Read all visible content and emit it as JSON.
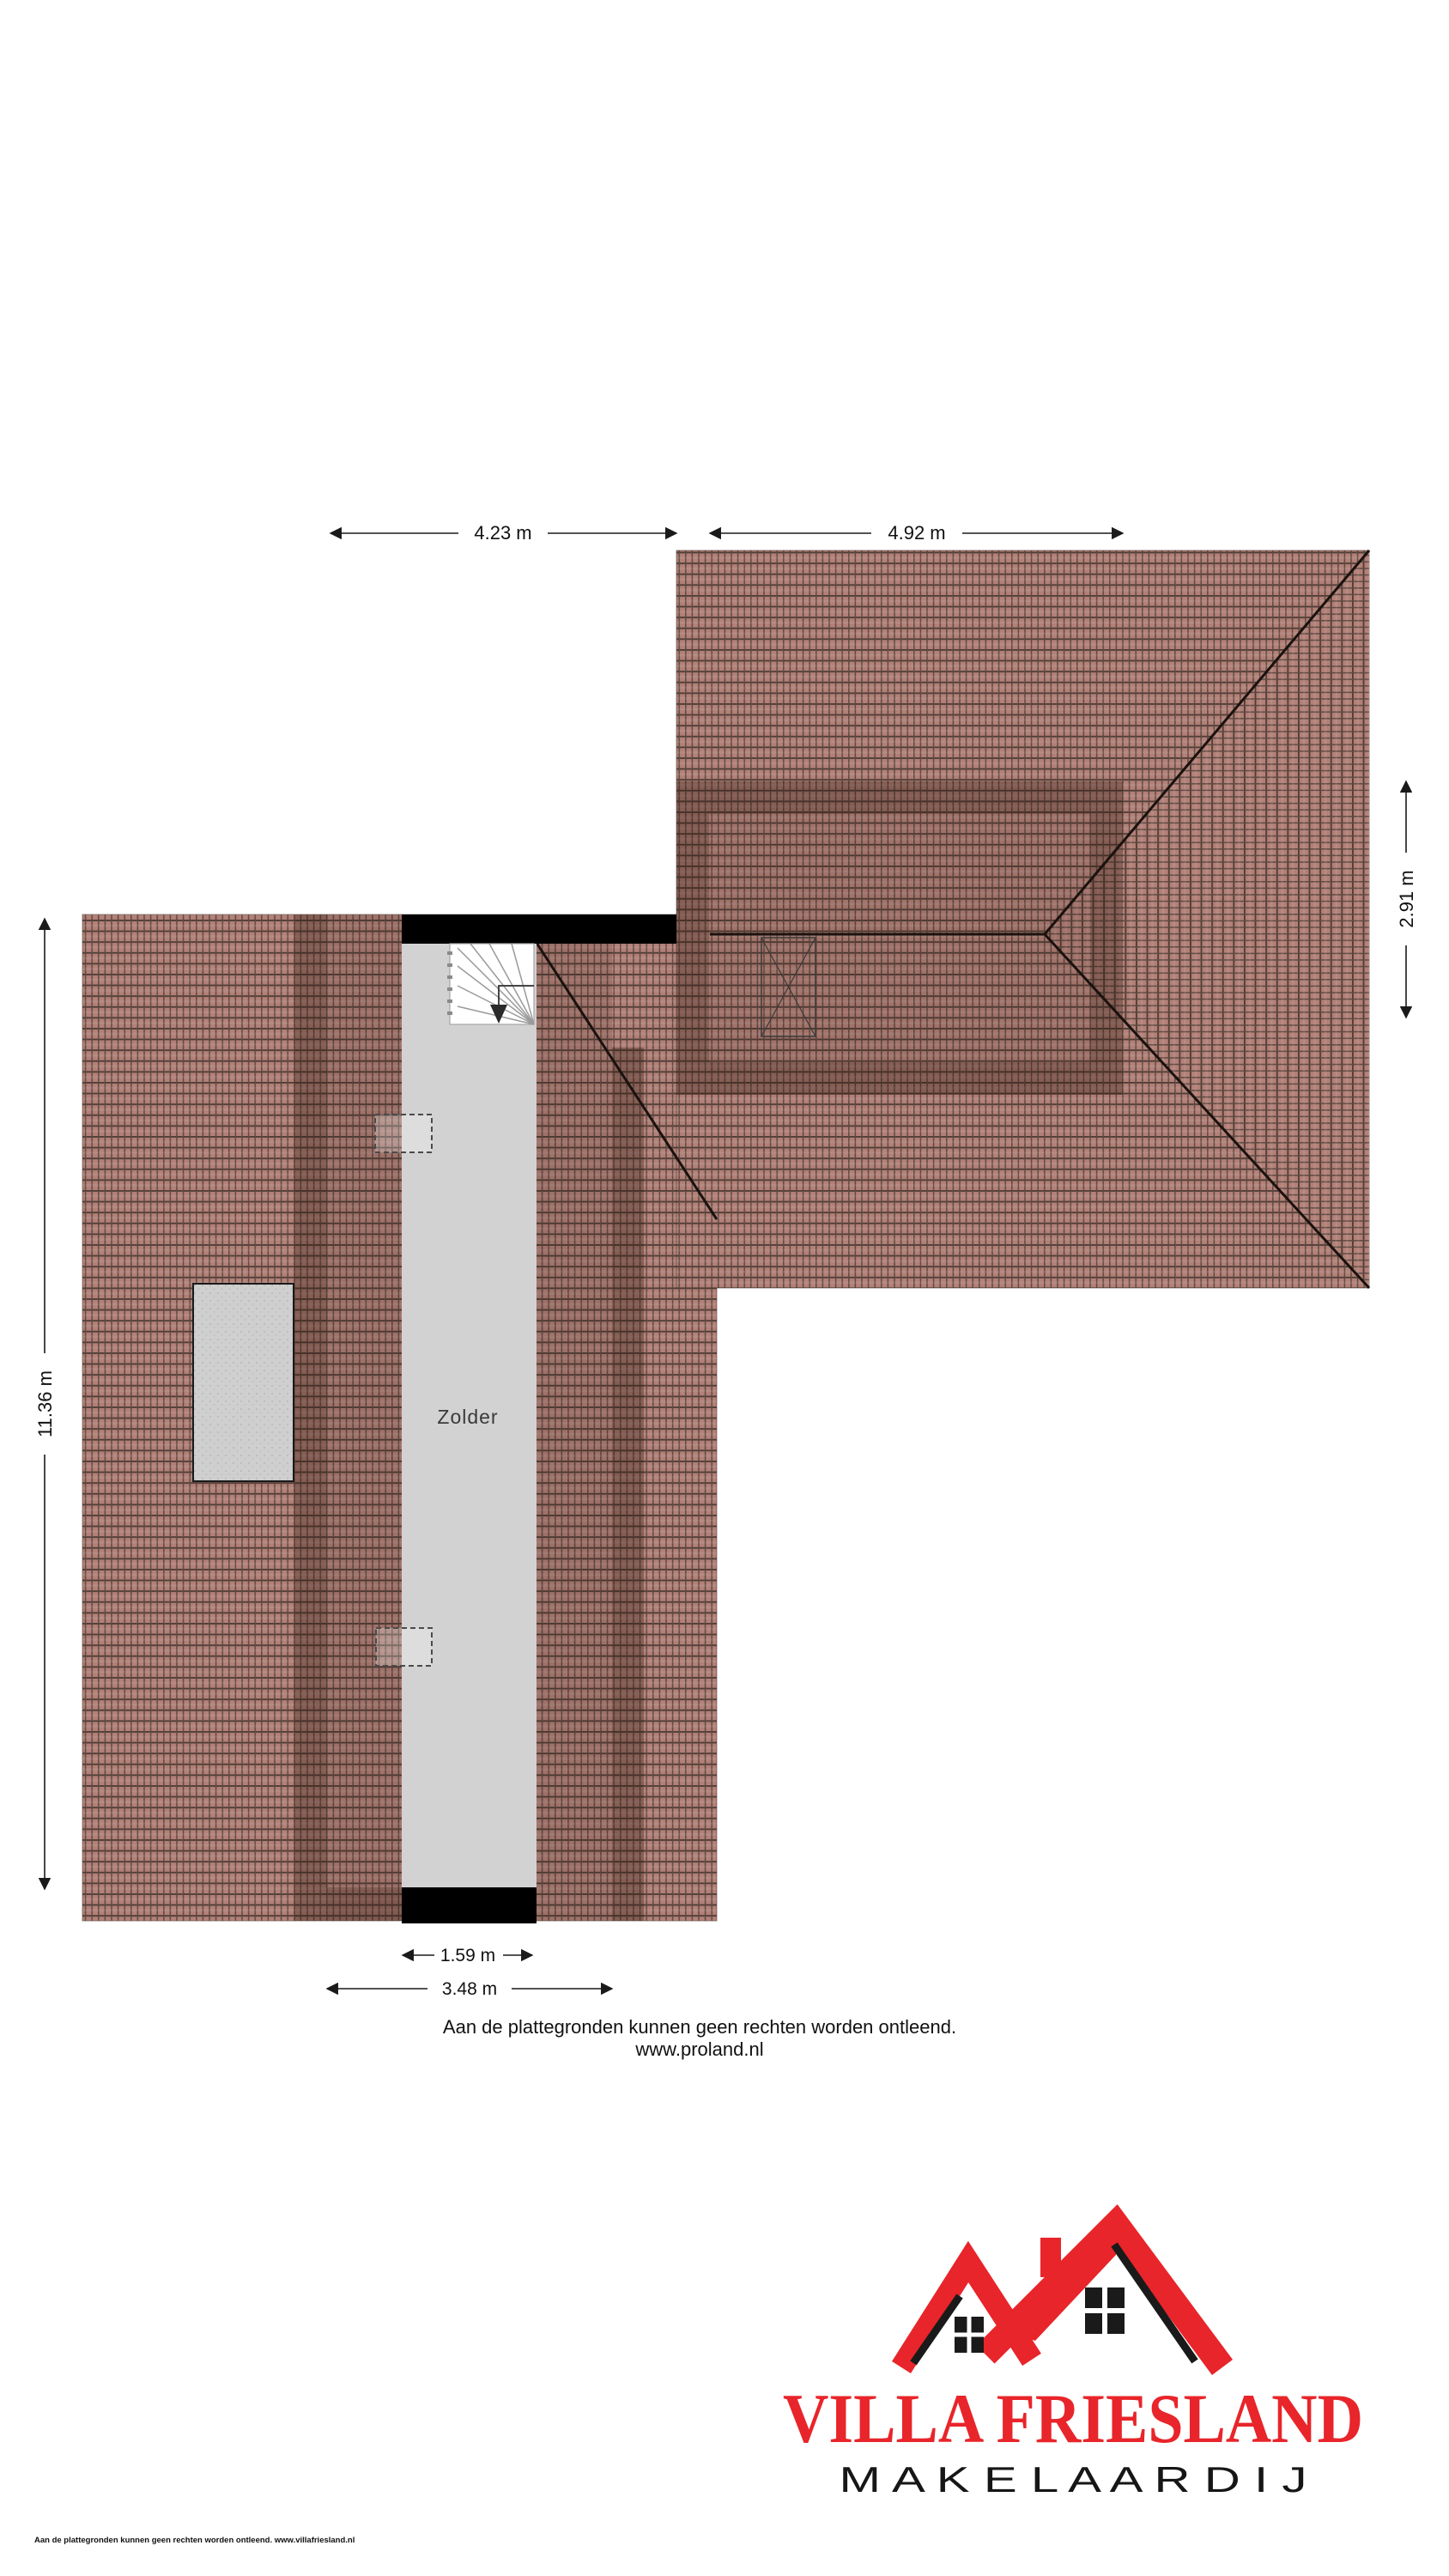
{
  "page": {
    "background": "#ffffff"
  },
  "floorplan": {
    "room_label": "Zolder",
    "dimensions": {
      "top_left": "4.23 m",
      "top_right": "4.92 m",
      "right_side": "2.91 m",
      "left_side": "11.36 m",
      "bottom_room": "1.59 m",
      "bottom_section": "3.48 m"
    },
    "colors": {
      "roof_tile": "#b28077",
      "roof_grout": "#54423c",
      "roof_shade": "#2a140c",
      "room_fill": "#d2d2d2",
      "dormer_fill": "#cfcfcf",
      "wall": "#000000"
    }
  },
  "footer": {
    "disclaimer": "Aan de plattegronden kunnen geen rechten worden ontleend.",
    "website": "www.proland.nl"
  },
  "legal_fine_print": "Aan de plattegronden kunnen geen rechten worden ontleend. www.villafriesland.nl",
  "logo": {
    "title": "VILLA FRIESLAND",
    "subtitle": "M A K E L A A R D I J",
    "accent_color": "#e8252a"
  }
}
